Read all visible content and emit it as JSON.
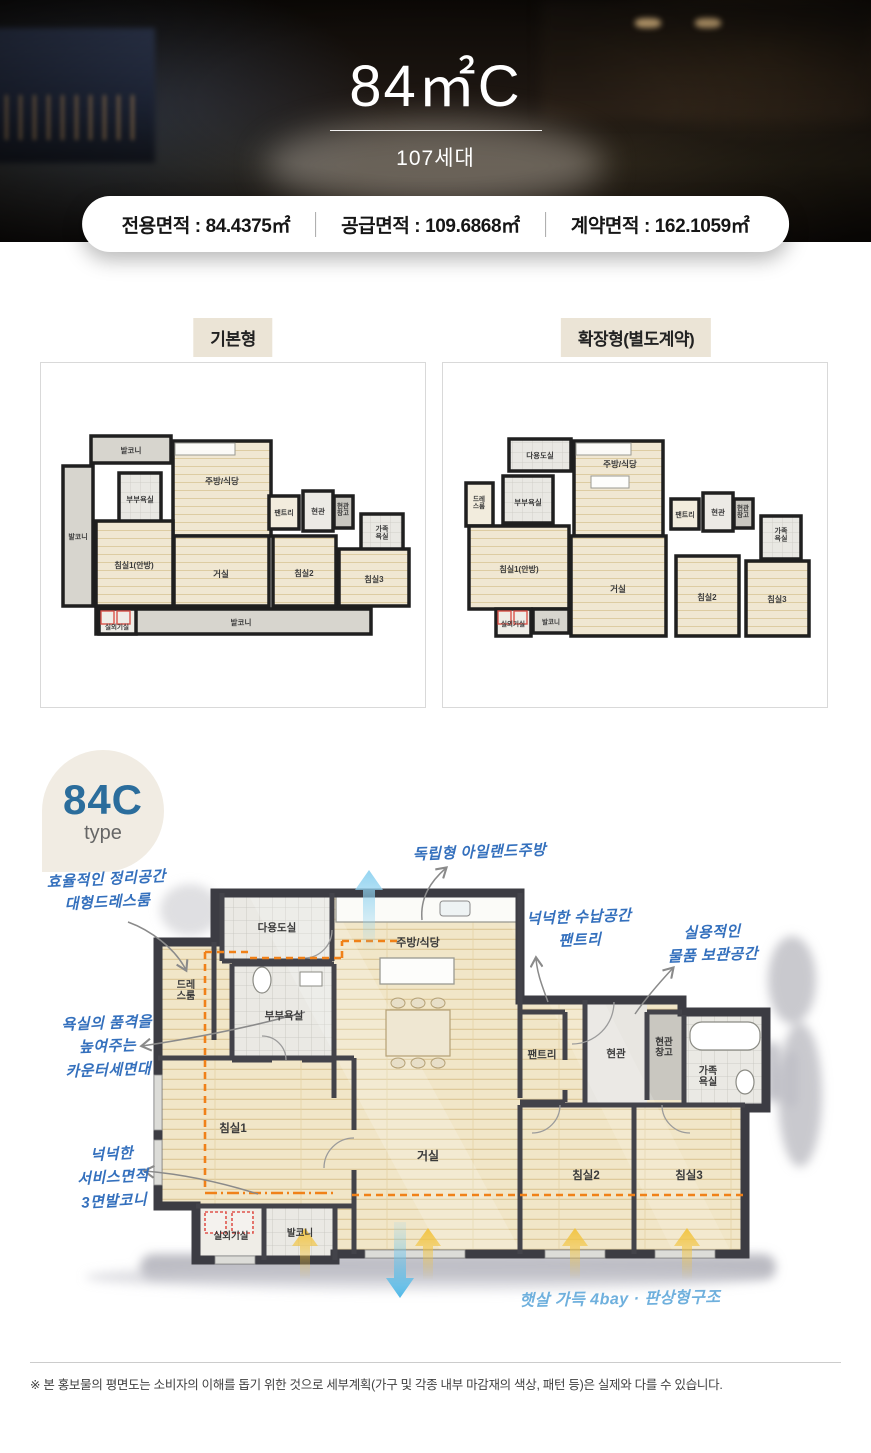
{
  "header": {
    "title": "84㎡C",
    "units": "107세대"
  },
  "area_banner": {
    "items": [
      "전용면적 : 84.4375㎡",
      "공급면적 : 109.6868㎡",
      "계약면적 : 162.1059㎡"
    ]
  },
  "plan_tabs": {
    "basic_label": "기본형",
    "extended_label": "확장형(별도계약)"
  },
  "basic_plan": {
    "rooms": {
      "balcony_top": "발코니",
      "kitchen_dining": "주방/식당",
      "master_bathroom": "부부욕실",
      "balcony_left": "발코니",
      "bedroom1": "침실1(안방)",
      "living_room": "거실",
      "pantry": "팬트리",
      "entrance": "현관",
      "entrance_storage": "현관\n창고",
      "family_bathroom": "가족\n욕실",
      "bedroom2": "침실2",
      "bedroom3": "침실3",
      "balcony_bottom": "발코니",
      "outdoor_unit_room": "실외기실"
    }
  },
  "extended_plan": {
    "rooms": {
      "utility": "다용도실",
      "kitchen_dining": "주방/식당",
      "dress_room": "드레\n스룸",
      "master_bathroom": "부부욕실",
      "bedroom1": "침실1(안방)",
      "living_room": "거실",
      "pantry": "팬트리",
      "entrance": "현관",
      "entrance_storage": "현관\n창고",
      "family_bathroom": "가족\n욕실",
      "bedroom2": "침실2",
      "bedroom3": "침실3",
      "balcony_small": "발코니",
      "outdoor_unit_room": "실외기실"
    }
  },
  "type_badge": {
    "title": "84C",
    "subtitle": "type"
  },
  "main_plan": {
    "rooms": {
      "utility": "다용도실",
      "kitchen_dining": "주방/식당",
      "dress_room": "드레\n스룸",
      "master_bathroom": "부부욕실",
      "pantry": "팬트리",
      "entrance": "현관",
      "entrance_storage": "현관\n창고",
      "family_bathroom": "가족\n욕실",
      "bedroom1": "침실1",
      "living_room": "거실",
      "bedroom2": "침실2",
      "bedroom3": "침실3",
      "outdoor_unit_room": "실외기실",
      "balcony": "발코니"
    },
    "annotations": {
      "dress_room": "효율적인 정리공간\n대형드레스룸",
      "island_kitchen": "독립형 아일랜드주방",
      "pantry": "넉넉한 수납공간\n팬트리",
      "storage": "실용적인\n물품 보관공간",
      "counter_basin": "욕실의 품격을\n높여주는\n카운터세면대",
      "balcony": "넉넉한\n서비스면적\n3면발코니",
      "sunlight": "햇살 가득 4bay · 판상형구조"
    }
  },
  "disclaimer": "※ 본 홍보물의 평면도는 소비자의 이해를 돕기 위한 것으로 세부계획(가구 및 각종 내부 마감재의 색상, 패턴 등)은 실제와 다를 수 있습니다.",
  "colors": {
    "annotation_blue": "#3470bd",
    "annotation_light_blue": "#6fb0dd",
    "extension_orange": "#f08119",
    "sun_arrow_yellow": "#f2c33e",
    "vent_arrow_blue": "#63c0ea",
    "badge_blue": "#2b6d9c",
    "label_beige": "#ebe4d6"
  }
}
